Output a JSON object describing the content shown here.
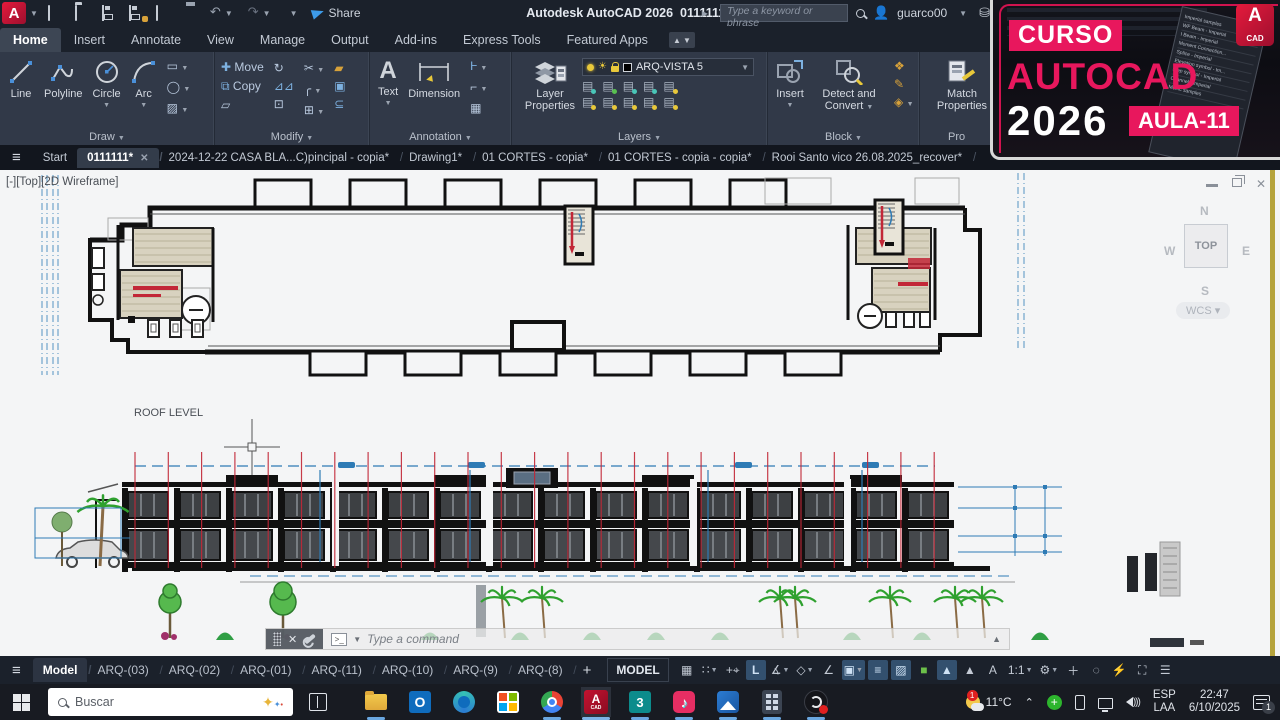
{
  "titlebar": {
    "app_title": "Autodesk AutoCAD 2026",
    "doc_title": "0111111.dwg",
    "share_label": "Share",
    "search_placeholder": "Type a keyword or phrase",
    "user": "guarco00"
  },
  "ribbon_tabs": [
    "Home",
    "Insert",
    "Annotate",
    "View",
    "Manage",
    "Output",
    "Add-ins",
    "Express Tools",
    "Featured Apps"
  ],
  "panels": {
    "draw": {
      "label": "Draw",
      "line": "Line",
      "polyline": "Polyline",
      "circle": "Circle",
      "arc": "Arc"
    },
    "modify": {
      "label": "Modify",
      "move": "Move",
      "copy": "Copy"
    },
    "annotation": {
      "label": "Annotation",
      "text": "Text",
      "dimension": "Dimension"
    },
    "layers": {
      "label": "Layers",
      "layer_properties": "Layer Properties",
      "current_layer": "ARQ-VISTA 5"
    },
    "block": {
      "label": "Block",
      "insert": "Insert",
      "detect": "Detect and Convert"
    },
    "properties": {
      "label": "Pro",
      "match": "Match Properties"
    }
  },
  "file_tabs": {
    "items": [
      {
        "label": "Start"
      },
      {
        "label": "0111111*"
      },
      {
        "label": "2024-12-22 CASA BLA...C)pincipal - copia*"
      },
      {
        "label": "Drawing1*"
      },
      {
        "label": "01 CORTES - copia*"
      },
      {
        "label": "01 CORTES - copia - copia*"
      },
      {
        "label": "Rooi Santo vico 26.08.2025_recover*"
      }
    ]
  },
  "viewport": {
    "label": "[-][Top][2D Wireframe]",
    "roof_level": "ROOF LEVEL",
    "command_placeholder": "Type a command",
    "viewcube": {
      "n": "N",
      "s": "S",
      "e": "E",
      "w": "W",
      "top": "TOP",
      "wcs": "WCS"
    }
  },
  "layout_bar": {
    "tabs": [
      "Model",
      "ARQ-(03)",
      "ARQ-(02)",
      "ARQ-(01)",
      "ARQ-(11)",
      "ARQ-(10)",
      "ARQ-(9)",
      "ARQ-(8)"
    ],
    "add": "+",
    "model_space": "MODEL",
    "ortho": "L",
    "scale": "1:1"
  },
  "taskbar": {
    "search_placeholder": "Buscar",
    "temperature": "11°C",
    "lang_line1": "ESP",
    "lang_line2": "LAA",
    "time": "22:47",
    "date": "6/10/2025",
    "notification_count": "1"
  },
  "promo": {
    "kicker": "CURSO",
    "brand": "AUTOCAD",
    "year": "2026",
    "badge": "AULA-11",
    "logo_letter": "A",
    "logo_sub": "CAD",
    "palette": [
      "Imperial samples",
      "WF Beam - Imperial",
      "I Beam - Imperial",
      "Moment Connection...",
      "Splice - Imperial",
      "Elevation symbol - Im...",
      "Step symbol - Imperial",
      "Channel - Imperial",
      "Metric samples"
    ]
  },
  "colors": {
    "accent_blue": "#2e7bb5",
    "grid_red": "#c22737",
    "promo_pink": "#e8175d",
    "layer_yellow": "#e8c83a"
  }
}
